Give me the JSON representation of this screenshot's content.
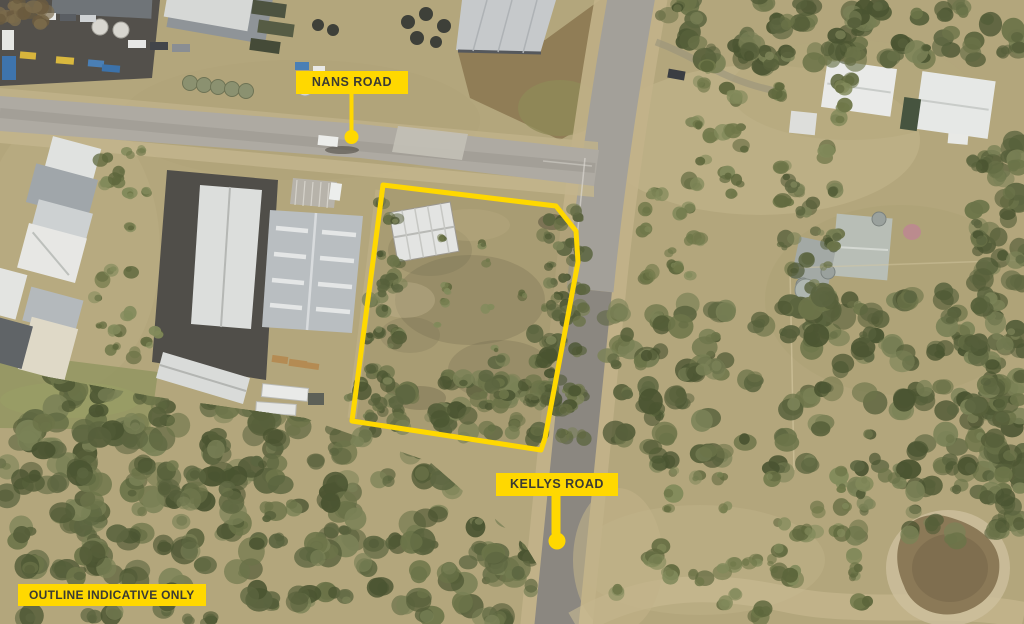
{
  "colors": {
    "annotation": "#FFD800",
    "annotation_text": "#3B3B33"
  },
  "labels": {
    "nans_road": "NANS ROAD",
    "kellys_road": "KELLYS ROAD",
    "disclaimer": "OUTLINE INDICATIVE ONLY"
  },
  "outline": {
    "points": "383,185 556,206 576,231 578,262 545,438 541,450 352,421"
  }
}
